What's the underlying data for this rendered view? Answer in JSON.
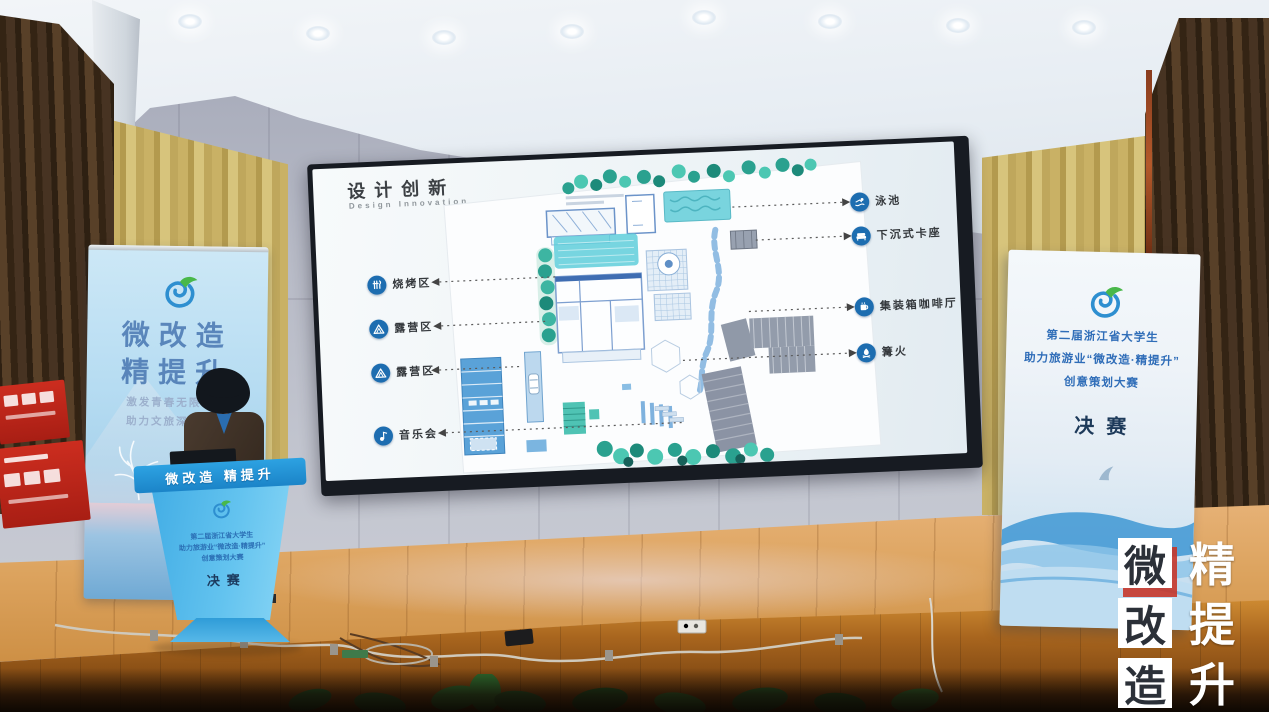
{
  "slide": {
    "title": "设计创新",
    "subtitle": "Design Innovation",
    "left_labels": [
      {
        "name": "bbq",
        "label": "烧烤区"
      },
      {
        "name": "camping-1",
        "label": "露营区"
      },
      {
        "name": "camping-2",
        "label": "露营区"
      },
      {
        "name": "concert",
        "label": "音乐会"
      }
    ],
    "right_labels": [
      {
        "name": "pool",
        "label": "泳池"
      },
      {
        "name": "sunken-seating",
        "label": "下沉式卡座"
      },
      {
        "name": "container-cafe",
        "label": "集装箱咖啡厅"
      },
      {
        "name": "bonfire",
        "label": "篝火"
      }
    ]
  },
  "left_banner": {
    "title_line1": "微改造",
    "title_line2": "精提升",
    "slogan_line1": "激发青春无限创意",
    "slogan_line2": "助力文旅深度融合"
  },
  "right_banner": {
    "line1": "第二届浙江省大学生",
    "line2": "助力旅游业“微改造·精提升”",
    "line3": "创意策划大赛",
    "stage_label": "决赛"
  },
  "podium": {
    "top_band": "微改造 精提升",
    "line1": "第二届浙江省大学生",
    "line2": "助力旅游业“微改造·精提升”",
    "line3": "创意策划大赛",
    "stage_label": "决赛"
  },
  "watermark": {
    "left_column": [
      "微",
      "改",
      "造"
    ],
    "right_column": [
      "精",
      "提",
      "升"
    ]
  },
  "colors": {
    "podium_blue": "#2f9fdc",
    "label_icon_blue": "#1d6db0",
    "plan_teal": "#3fbfae",
    "watermark_red": "#c7362a",
    "stage_wood": "#dca35e"
  }
}
